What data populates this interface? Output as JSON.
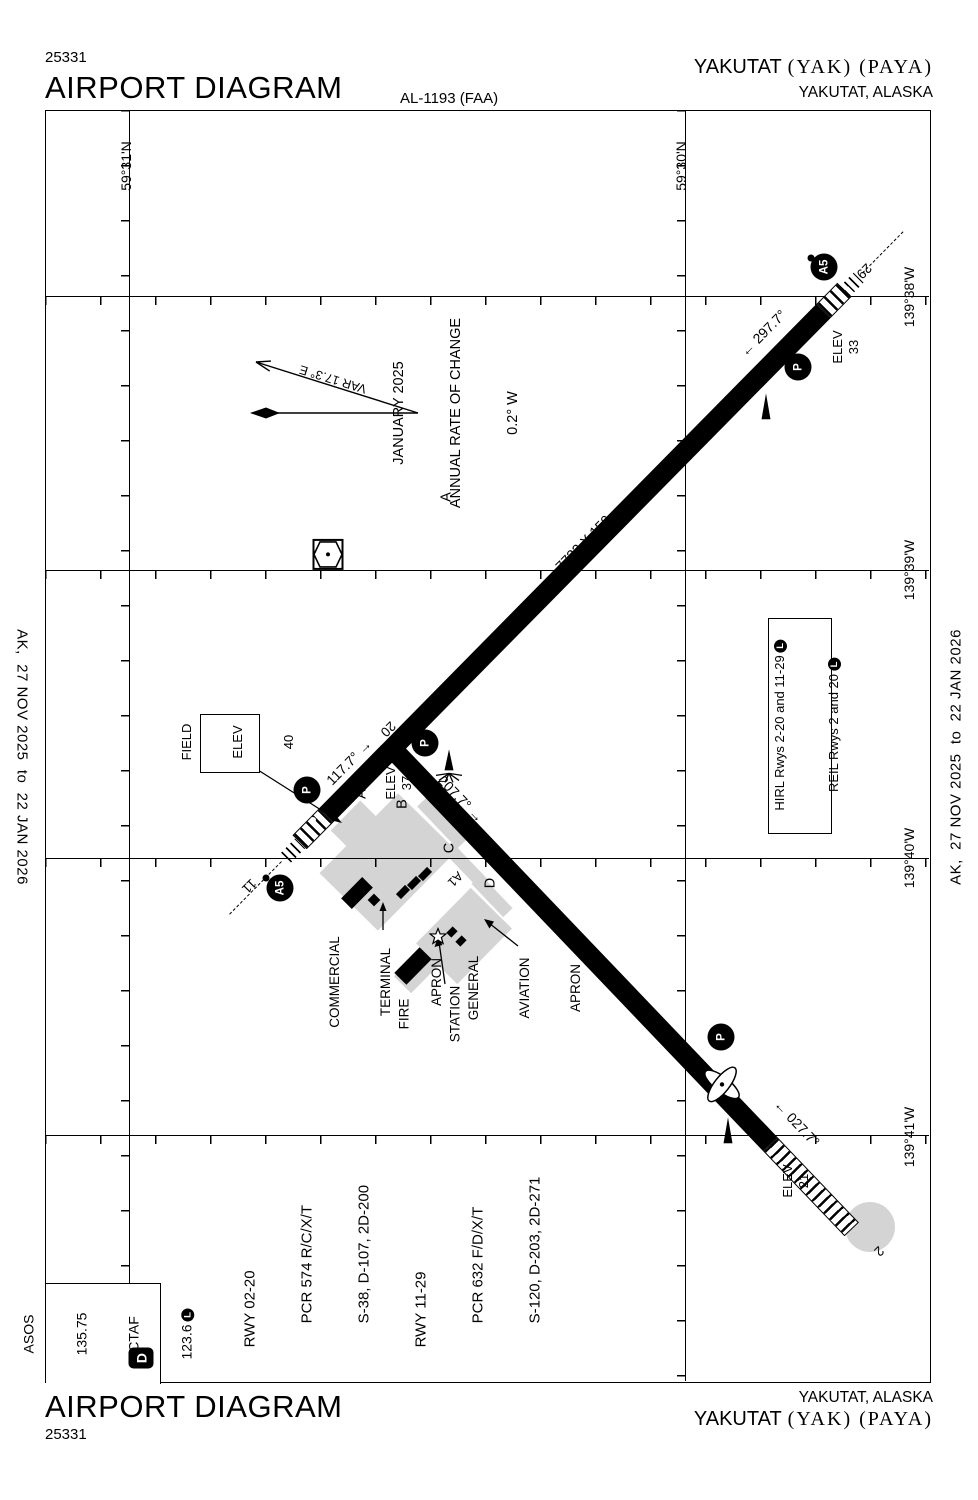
{
  "header": {
    "code": "25331",
    "title": "AIRPORT DIAGRAM",
    "al": "AL-1193 (FAA)",
    "name": "YAKUTAT",
    "name_serif": "(YAK) (PAYA)",
    "city": "YAKUTAT, ALASKA"
  },
  "footer": {
    "code": "25331",
    "title": "AIRPORT DIAGRAM",
    "name": "YAKUTAT",
    "name_serif": "(YAK) (PAYA)",
    "city": "YAKUTAT, ALASKA"
  },
  "effective": {
    "left": "AK,  27 NOV 2025  to  22 JAN 2026",
    "right": "AK,  27 NOV 2025  to  22 JAN 2026"
  },
  "grid": {
    "lat": [
      "59°31'N",
      "59°30'N"
    ],
    "lon": [
      "139°38'W",
      "139°39'W",
      "139°40'W",
      "139°41'W"
    ]
  },
  "compass": {
    "var": "VAR 17.3° E",
    "line1": "JANUARY 2025",
    "line2": "ANNUAL RATE OF CHANGE",
    "line3": "0.2° W"
  },
  "field_elev": {
    "line1": "FIELD",
    "line2": "ELEV",
    "line3": "40"
  },
  "rwy1129": {
    "dim": "7732 X 150",
    "num11": "11",
    "num29": "29",
    "hdg11": "117.7°",
    "hdg29": "297.7°"
  },
  "rwy0220": {
    "dim": "6475 X 150",
    "num20": "20",
    "num2": "2",
    "hdg20": "207.7°",
    "hdg2": "027.7°"
  },
  "elev": {
    "label": "ELEV",
    "e29": "33",
    "e20": "37",
    "e2": "21"
  },
  "taxiways": {
    "a": "A",
    "a_mid": "A",
    "b": "B",
    "c": "C",
    "a1": "A1",
    "d": "D"
  },
  "badges": {
    "a5": "A5",
    "p": "P"
  },
  "aprons": {
    "commercial": [
      "COMMERCIAL",
      "TERMINAL",
      "APRON"
    ],
    "fire": [
      "FIRE",
      "STATION"
    ],
    "ga": [
      "GENERAL",
      "AVIATION",
      "APRON"
    ]
  },
  "lighting": {
    "hirl": "HIRL Rwys 2-20 and 11-29",
    "reil": "REIL Rwys 2 and 20",
    "l": "L"
  },
  "comms": {
    "asos": "ASOS",
    "asos_freq": "135.75",
    "ctaf": "CTAF",
    "ctaf_freq": "123.6",
    "l": "L",
    "d": "D"
  },
  "rwy_data": [
    "RWY 02-20",
    "PCR 574 R/C/X/T",
    "S-38, D-107, 2D-200",
    "RWY 11-29",
    "PCR 632 F/D/X/T",
    "S-120, D-203, 2D-271"
  ],
  "icons": {
    "arrow_left": "←",
    "arrow_right": "→"
  }
}
